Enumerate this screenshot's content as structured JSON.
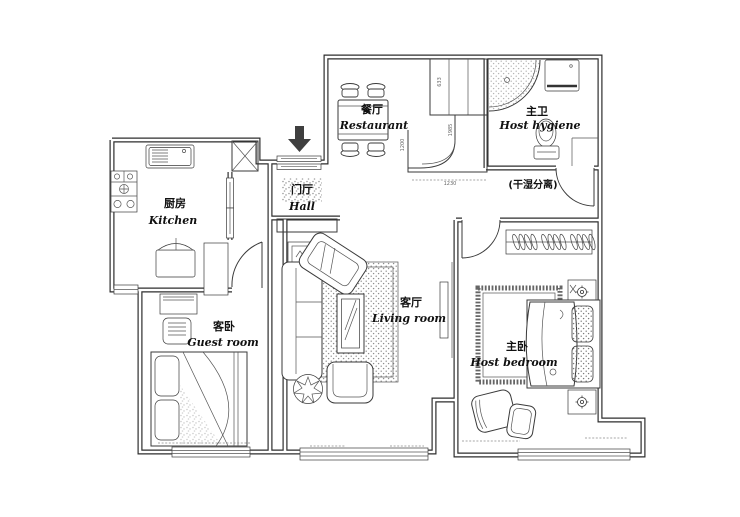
{
  "plan_title": "apartment-floor-plan",
  "rooms": {
    "kitchen": {
      "zh": "厨房",
      "en": "Kitchen"
    },
    "dining": {
      "zh": "餐厅",
      "en": "Restaurant"
    },
    "master_bath": {
      "zh": "主卫",
      "en": "Host hygiene"
    },
    "hall": {
      "zh": "门厅",
      "en": "Hall"
    },
    "guest_bedroom": {
      "zh": "客卧",
      "en": "Guest room"
    },
    "living_room": {
      "zh": "客厅",
      "en": "Living room"
    },
    "master_bedroom": {
      "zh": "主卧",
      "en": "Host bedroom"
    }
  },
  "notes": {
    "dry_wet_separation": "(干湿分离)"
  },
  "dimensions": {
    "cabinet_upper": "633",
    "cabinet_lower": "1985",
    "counter_left": "1200",
    "counter_bottom": "1230"
  },
  "colors": {
    "wall_line": "#2e2e2e",
    "furniture_line": "#3a3a3a",
    "background": "#ffffff",
    "entry_arrow": "#3f3f3f"
  }
}
